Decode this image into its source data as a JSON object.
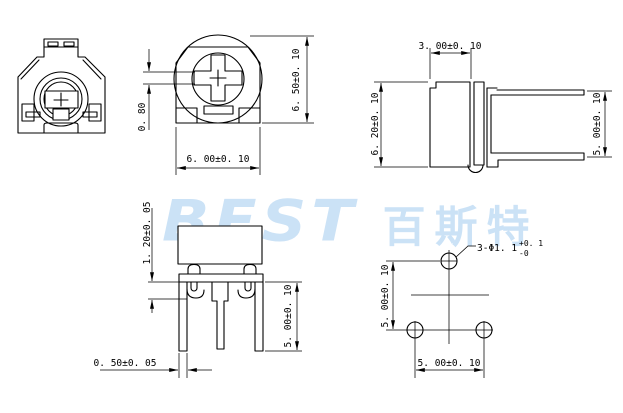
{
  "colors": {
    "line": "#000000",
    "watermark": "#cbe2f6",
    "background": "#ffffff"
  },
  "watermark": {
    "logo_text": "BEST",
    "cn_text": "百斯特"
  },
  "dimensions": {
    "slot_width": "0. 80",
    "front_height": "6. 50±0. 10",
    "front_width": "6. 00±0. 10",
    "side_depth": "3. 00±0. 10",
    "side_height": "6. 20±0. 10",
    "side_pin_spacing": "5. 00±0. 10",
    "standoff_height": "1. 20±0. 05",
    "leg_length": "5. 00±0. 10",
    "leg_width": "0. 50±0. 05",
    "hole_spacing_vertical": "5. 00±0. 10",
    "hole_spacing_horizontal": "5. 00±0. 10",
    "hole_callout": "3-Φ1. 1",
    "hole_tolerance_plus": "+0. 1",
    "hole_tolerance_minus": "-0"
  }
}
